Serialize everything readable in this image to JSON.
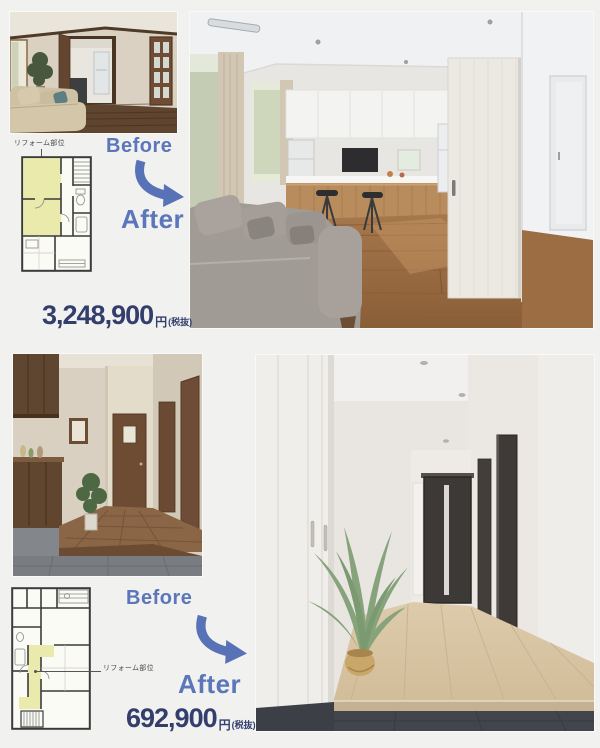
{
  "page": {
    "background": "#f1f1ef"
  },
  "colors": {
    "accent_blue": "#5b76ba",
    "arrow_blue": "#5872b8",
    "price_navy": "#333e6d",
    "plan_highlight_yellow": "#e9eaab"
  },
  "sections": [
    {
      "name": "living-dining-kitchen-reform",
      "plan_label": "リフォーム部位",
      "before_label": "Before",
      "after_label": "After",
      "price_amount": "3,248,900",
      "price_unit": "円",
      "price_note": "(税抜)"
    },
    {
      "name": "entrance-hallway-reform",
      "plan_label": "リフォーム部位",
      "before_label": "Before",
      "after_label": "After",
      "price_amount": "692,900",
      "price_unit": "円",
      "price_note": "(税抜)"
    }
  ]
}
